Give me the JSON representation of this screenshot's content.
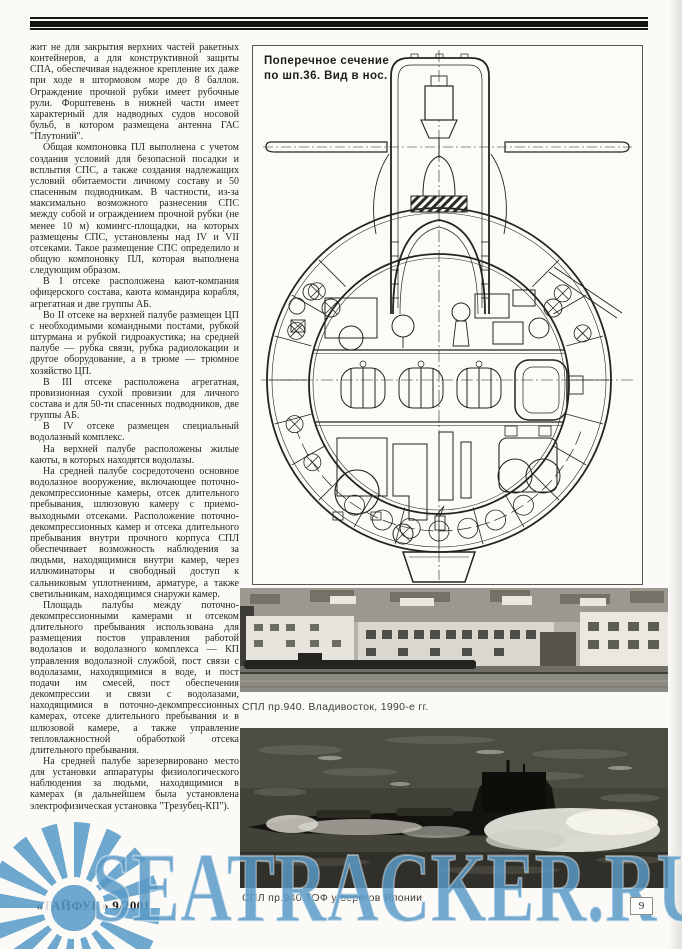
{
  "colors": {
    "paper": "#fbfaf7",
    "ink": "#26261f",
    "watermark_blue": "#5a9ac7"
  },
  "article": {
    "paragraphs": [
      "жит не для закрытия верхних частей ракетных контейнеров, а для конструктивной защиты СПА, обеспечивая надежное крепление их даже при ходе в штормовом море до 8 баллов. Ограждение прочной рубки имеет рубочные рули. Форштевень в нижней части имеет характерный для надводных судов носовой бульб, в котором размещена антенна ГАС \"Плутоний\".",
      "Общая компоновка ПЛ выполнена с учетом создания условий для безопасной посадки и всплытия СПС, а также создания надлежащих условий обитаемости личному составу и 50 спасенным подводникам. В частности, из-за максимально возможного разнесения СПС между собой и ограждением прочной рубки (не менее 10 м) комингс-площадки, на которых размещены СПС, установлены над IV и VII отсеками. Такое размещение СПС определило и общую компоновку ПЛ, которая выполнена следующим образом.",
      "В I отсеке расположена кают-компания офицерского состава, каюта командира корабля, агрегатная и две группы АБ.",
      "Во II отсеке на верхней палубе размещен ЦП с необходимыми командными постами, рубкой штурмана и рубкой гидроакустика; на средней палубе — рубка связи, рубка радиолокации и другое оборудование, а в трюме — трюмное хозяйство ЦП.",
      "В III отсеке расположена агрегатная, провизионная сухой провизии для личного состава и для 50-ти спасенных подводников, две группы АБ.",
      "В IV отсеке размещен специальный водолазный комплекс.",
      "На верхней палубе расположены жилые каюты, в которых находятся водолазы.",
      "На средней палубе сосредоточено основное водолазное вооружение, включающее поточно-декомпрессионные камеры, отсек длительного пребывания, шлюзовую камеру с приемо-выходными отсеками. Расположение поточно-декомпрессионных камер и отсека длительного пребывания внутри прочного корпуса СПЛ обеспечивает возможность наблюдения за людьми, находящимися внутри камер, через иллюминаторы и свободный доступ к сальниковым уплотнениям, арматуре, а также светильникам, находящимся снаружи камер.",
      "Площадь палубы между поточно-декомпрессионными камерами и отсеком длительного пребывания использована для размещения постов управления работой водолазов и водолазного комплекса — КП управления водолазной службой, пост связи с водолазами, находящимися в воде, и пост подачи им смесей, пост обеспечения декомпрессии и связи с водолазами, находящимися в поточно-декомпрессионных камерах, отсеке длительного пребывания и в шлюзовой камере, а также управление тепловлажностной обработкой отсека длительного пребывания.",
      "На средней палубе зарезервировано место для установки аппаратуры физиологического наблюдения за людьми, находящимися в камерах (в дальнейшем была установлена электрофизическая установка \"Трезубец-КП\")."
    ]
  },
  "figures": {
    "diagram": {
      "caption_line1": "Поперечное сечение",
      "caption_line2": "по шп.36. Вид в нос."
    },
    "photo_vladivostok": {
      "caption": "СПЛ пр.940. Владивосток, 1990-е гг."
    },
    "photo_japan": {
      "caption": "СПЛ пр.940 ТОФ у берегов Японии"
    }
  },
  "footer": {
    "issue": "«ТАЙФУН» 9/2001",
    "page_number": "9"
  },
  "watermark": {
    "text": "SEATRACKER.RU"
  }
}
